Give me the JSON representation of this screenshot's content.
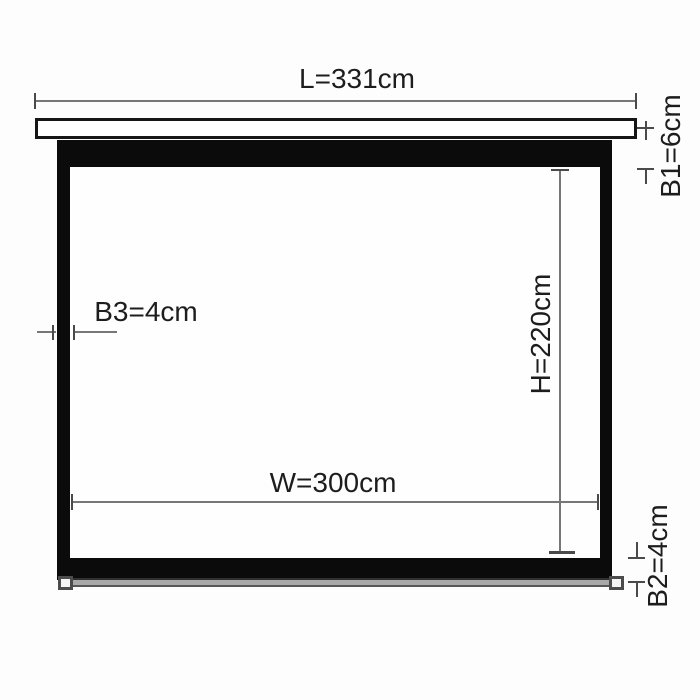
{
  "title": "Projection screen dimension diagram",
  "diagram": {
    "parts": {
      "casing": "top housing case",
      "frame": "black screen border frame",
      "screen": "white viewing surface",
      "bottom_bar": "weighted bottom slat with end caps"
    },
    "dimensions": {
      "L": {
        "name": "total casing length",
        "label": "L=331cm",
        "value_cm": 331
      },
      "B1": {
        "name": "top black border height",
        "label": "B1=6cm",
        "value_cm": 6
      },
      "B3": {
        "name": "side black border width",
        "label": "B3=4cm",
        "value_cm": 4
      },
      "H": {
        "name": "viewing area height",
        "label": "H=220cm",
        "value_cm": 220
      },
      "W": {
        "name": "viewing area width",
        "label": "W=300cm",
        "value_cm": 300
      },
      "B2": {
        "name": "bottom black border height",
        "label": "B2=4cm",
        "value_cm": 4
      }
    },
    "colors": {
      "background": "#fdfdfd",
      "frame_black": "#0b0b0b",
      "screen_white": "#fefefe",
      "casing_border": "#161616",
      "dimension_line_gray": "#777777",
      "tick_gray": "#4a4a4a",
      "bar_gray": "#a9a9a9",
      "text": "#1d1d1d"
    }
  }
}
